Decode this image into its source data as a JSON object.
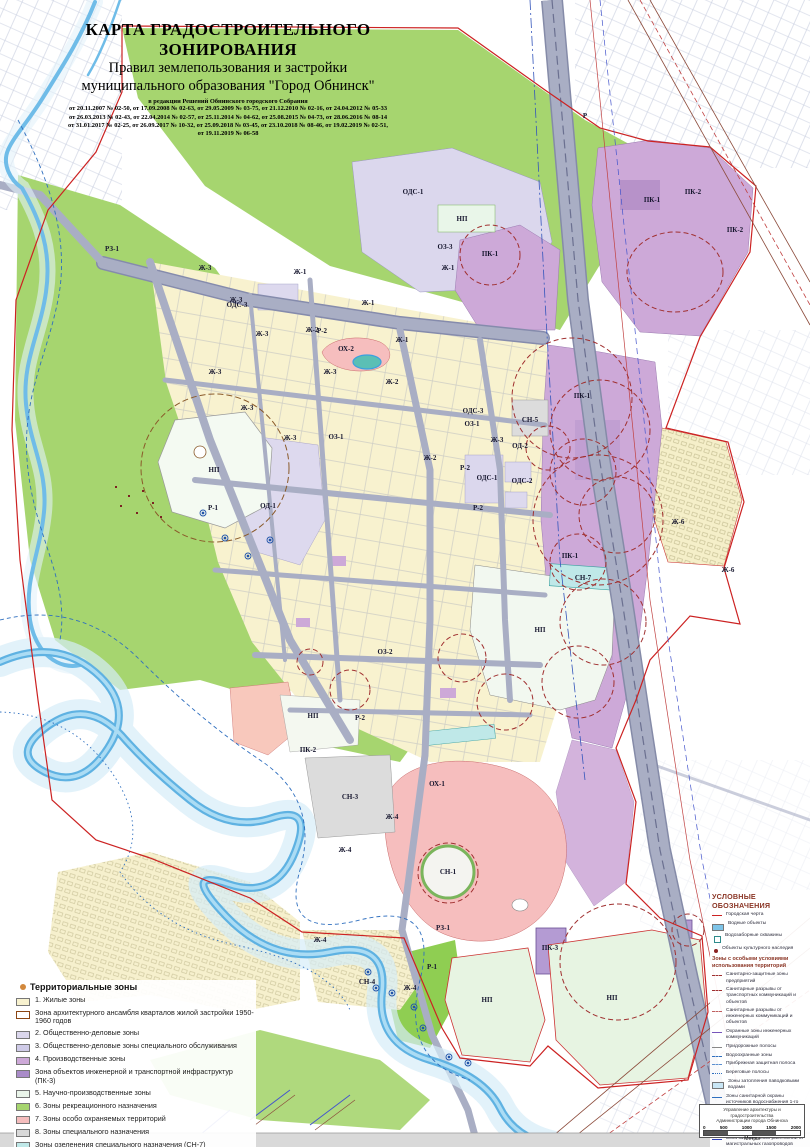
{
  "title": {
    "line1": "КАРТА ГРАДОСТРОИТЕЛЬНОГО ЗОНИРОВАНИЯ",
    "line2": "Правил землепользования и застройки",
    "line3": "муниципального образования \"Город Обнинск\"",
    "edition_header": "в редакции Решений Обнинского городского Собрания",
    "edition_lines": [
      "от 20.11.2007 № 02-50,  от 17.09.2008 № 02-63,  от 29.05.2009 № 03-75, от 21.12.2010 № 02-16, от 24.04.2012 № 05-33",
      "от 26.03.2013 № 02-43, от 22.04.2014 № 02-57, от 25.11.2014 № 04-62, от 25.08.2015 № 04-73, от 28.06.2016 № 08-14",
      "от 31.01.2017 № 02-25, от 26.09.2017 № 10-32, от 25.09.2018 № 03-45, от 23.10.2018 № 08-46, от 19.02.2019 № 02-51,",
      "от 19.11.2019 № 06-58"
    ]
  },
  "map": {
    "zone_labels": [
      {
        "t": "Р",
        "x": 585,
        "y": 116
      },
      {
        "t": "РЗ-1",
        "x": 112,
        "y": 249
      },
      {
        "t": "Ж-3",
        "x": 205,
        "y": 268
      },
      {
        "t": "Ж-3",
        "x": 236,
        "y": 300
      },
      {
        "t": "Ж-3",
        "x": 262,
        "y": 334
      },
      {
        "t": "Ж-3",
        "x": 215,
        "y": 372
      },
      {
        "t": "Ж-3",
        "x": 247,
        "y": 408
      },
      {
        "t": "Ж-3",
        "x": 290,
        "y": 438
      },
      {
        "t": "Ж-3",
        "x": 330,
        "y": 372
      },
      {
        "t": "Ж-3",
        "x": 497,
        "y": 440
      },
      {
        "t": "Ж-1",
        "x": 300,
        "y": 272
      },
      {
        "t": "Ж-1",
        "x": 368,
        "y": 303
      },
      {
        "t": "Ж-1",
        "x": 402,
        "y": 340
      },
      {
        "t": "Ж-1",
        "x": 448,
        "y": 268
      },
      {
        "t": "Ж-2",
        "x": 312,
        "y": 330
      },
      {
        "t": "Ж-2",
        "x": 392,
        "y": 382
      },
      {
        "t": "Ж-2",
        "x": 430,
        "y": 458
      },
      {
        "t": "ОЗ-3",
        "x": 445,
        "y": 247
      },
      {
        "t": "ОДС-1",
        "x": 413,
        "y": 192
      },
      {
        "t": "НП",
        "x": 462,
        "y": 219
      },
      {
        "t": "ОДС-3",
        "x": 237,
        "y": 305
      },
      {
        "t": "ОДС-3",
        "x": 473,
        "y": 411
      },
      {
        "t": "ОХ-2",
        "x": 346,
        "y": 349
      },
      {
        "t": "Р-2",
        "x": 322,
        "y": 331
      },
      {
        "t": "Р-2",
        "x": 465,
        "y": 468
      },
      {
        "t": "Р-2",
        "x": 478,
        "y": 508
      },
      {
        "t": "Р-2",
        "x": 360,
        "y": 718
      },
      {
        "t": "Р-1",
        "x": 213,
        "y": 508
      },
      {
        "t": "Р-1",
        "x": 432,
        "y": 967
      },
      {
        "t": "НП",
        "x": 214,
        "y": 470
      },
      {
        "t": "ОД-1",
        "x": 268,
        "y": 506
      },
      {
        "t": "ОДС-1",
        "x": 487,
        "y": 478
      },
      {
        "t": "ОДС-2",
        "x": 522,
        "y": 481
      },
      {
        "t": "ОД-2",
        "x": 520,
        "y": 446
      },
      {
        "t": "СН-5",
        "x": 530,
        "y": 420
      },
      {
        "t": "ОЗ-1",
        "x": 336,
        "y": 437
      },
      {
        "t": "ОЗ-1",
        "x": 472,
        "y": 424
      },
      {
        "t": "ОЗ-2",
        "x": 385,
        "y": 652
      },
      {
        "t": "ПК-1",
        "x": 490,
        "y": 254
      },
      {
        "t": "ПК-1",
        "x": 652,
        "y": 200
      },
      {
        "t": "ПК-1",
        "x": 582,
        "y": 396
      },
      {
        "t": "ПК-1",
        "x": 570,
        "y": 556
      },
      {
        "t": "ПК-2",
        "x": 693,
        "y": 192
      },
      {
        "t": "ПК-2",
        "x": 735,
        "y": 230
      },
      {
        "t": "ПК-2",
        "x": 308,
        "y": 750
      },
      {
        "t": "ПК-3",
        "x": 550,
        "y": 948
      },
      {
        "t": "Ж-6",
        "x": 678,
        "y": 522
      },
      {
        "t": "Ж-6",
        "x": 728,
        "y": 570
      },
      {
        "t": "НП",
        "x": 313,
        "y": 716
      },
      {
        "t": "НП",
        "x": 540,
        "y": 630
      },
      {
        "t": "НП",
        "x": 487,
        "y": 1000
      },
      {
        "t": "НП",
        "x": 612,
        "y": 998
      },
      {
        "t": "ОХ-1",
        "x": 437,
        "y": 784
      },
      {
        "t": "СН-3",
        "x": 350,
        "y": 797
      },
      {
        "t": "СН-1",
        "x": 448,
        "y": 872
      },
      {
        "t": "СН-4",
        "x": 367,
        "y": 982
      },
      {
        "t": "Ж-4",
        "x": 392,
        "y": 817
      },
      {
        "t": "Ж-4",
        "x": 345,
        "y": 850
      },
      {
        "t": "Ж-4",
        "x": 320,
        "y": 940
      },
      {
        "t": "Ж-4",
        "x": 410,
        "y": 988
      },
      {
        "t": "СН-7",
        "x": 583,
        "y": 578
      },
      {
        "t": "РЗ-1",
        "x": 443,
        "y": 928
      }
    ]
  },
  "legend_zones": {
    "title": "Территориальные зоны",
    "items": [
      {
        "label": "1. Жилые зоны",
        "color": "#f8f2cf"
      },
      {
        "label": "Зона архитектурного ансамбля кварталов жилой застройки 1950-1960 годов",
        "color": "#ffffff",
        "outline": "#8b4513",
        "sub": true
      },
      {
        "label": "2. Общественно-деловые зоны",
        "color": "#dbd7ed"
      },
      {
        "label": "3. Общественно-деловые зоны специального обслуживания",
        "color": "#cfcbe8"
      },
      {
        "label": "4. Производственные зоны",
        "color": "#cda9d8"
      },
      {
        "label": "Зона объектов инженерной и транспортной инфраструктур (ПК-3)",
        "color": "#a98bc8",
        "sub": true
      },
      {
        "label": "5. Научно-производственные зоны",
        "color": "#eaf5ea"
      },
      {
        "label": "6. Зоны рекреационного назначения",
        "color": "#a6d56f"
      },
      {
        "label": "7. Зоны особо охраняемых территорий",
        "color": "#f5bdbd"
      },
      {
        "label": "8. Зоны специального назначения",
        "color": "#d9d9d9"
      },
      {
        "label": "Зоны озеленения специального назначения (СН-7)",
        "color": "#bfe8e8",
        "sub": true
      },
      {
        "label": "9. Зоны резервных территорий",
        "color": "#ffffff"
      },
      {
        "label": "10. Зоны автовокзала",
        "color": "#c9d6f2"
      }
    ]
  },
  "legend_symbols": {
    "title": "УСЛОВНЫЕ ОБОЗНАЧЕНИЯ",
    "items": [
      {
        "label": "Городская черта",
        "icon": "line",
        "color": "#cc2222",
        "name": "city-boundary"
      },
      {
        "label": "Водные объекты",
        "icon": "fill",
        "color": "#7ec4e8",
        "name": "water-objects"
      },
      {
        "label": "Водозаборные скважины",
        "icon": "square",
        "color": "#2e8b8b",
        "name": "water-well"
      },
      {
        "label": "Объекты культурного наследия",
        "icon": "marker",
        "color": "#8b2222",
        "name": "heritage"
      },
      {
        "header": "Зоны с особыми условиями использования территорий"
      },
      {
        "label": "Санитарно-защитные зоны предприятий",
        "icon": "dash",
        "color": "#a03030",
        "name": "sanitary-zone"
      },
      {
        "label": "Санитарные разрывы от транспортных коммуникаций и объектов",
        "icon": "dash",
        "color": "#a03030",
        "name": "transport-gap"
      },
      {
        "label": "Санитарные разрывы от инженерных коммуникаций и объектов",
        "icon": "dash",
        "color": "#c06060",
        "name": "utility-gap"
      },
      {
        "label": "Охранные зоны инженерных коммуникаций",
        "icon": "line",
        "color": "#7755bb",
        "name": "utility-protection"
      },
      {
        "label": "Придорожные полосы",
        "icon": "line",
        "color": "#888888",
        "name": "roadside-strip"
      },
      {
        "label": "Водоохранные зоны",
        "icon": "dash",
        "color": "#2f6fbf",
        "name": "water-protection"
      },
      {
        "label": "Прибрежная защитная полоса",
        "icon": "dash",
        "color": "#5b8fd0",
        "name": "coastal-strip"
      },
      {
        "label": "Береговые полосы",
        "icon": "dots",
        "color": "#2f6fbf",
        "name": "shore-strip"
      },
      {
        "label": "Зоны затопления паводковыми водами",
        "icon": "fill",
        "color": "#c9e6f5",
        "name": "flood-zone"
      },
      {
        "label": "Зоны санитарной охраны источников водоснабжения 1-го пояса и водоводов",
        "icon": "line",
        "color": "#2f6fbf",
        "name": "water-source-protection"
      },
      {
        "label": "Охранная зона сейсмометров \"Центра Геофизической службы РАН\"",
        "icon": "dash",
        "color": "#8a5a2a",
        "name": "seismometer-zone"
      },
      {
        "label": "Зона минимальных расстояний от магистральных газопроводов высокого давления",
        "icon": "line",
        "color": "#3344bb",
        "name": "gas-main-zone"
      }
    ]
  },
  "scale_box": {
    "credit1": "Управление архитектуры и градостроительства",
    "credit2": "Администрации города Обнинска",
    "ticks": [
      "0",
      "500",
      "1000",
      "1500",
      "2000"
    ],
    "unit": "Метры"
  }
}
